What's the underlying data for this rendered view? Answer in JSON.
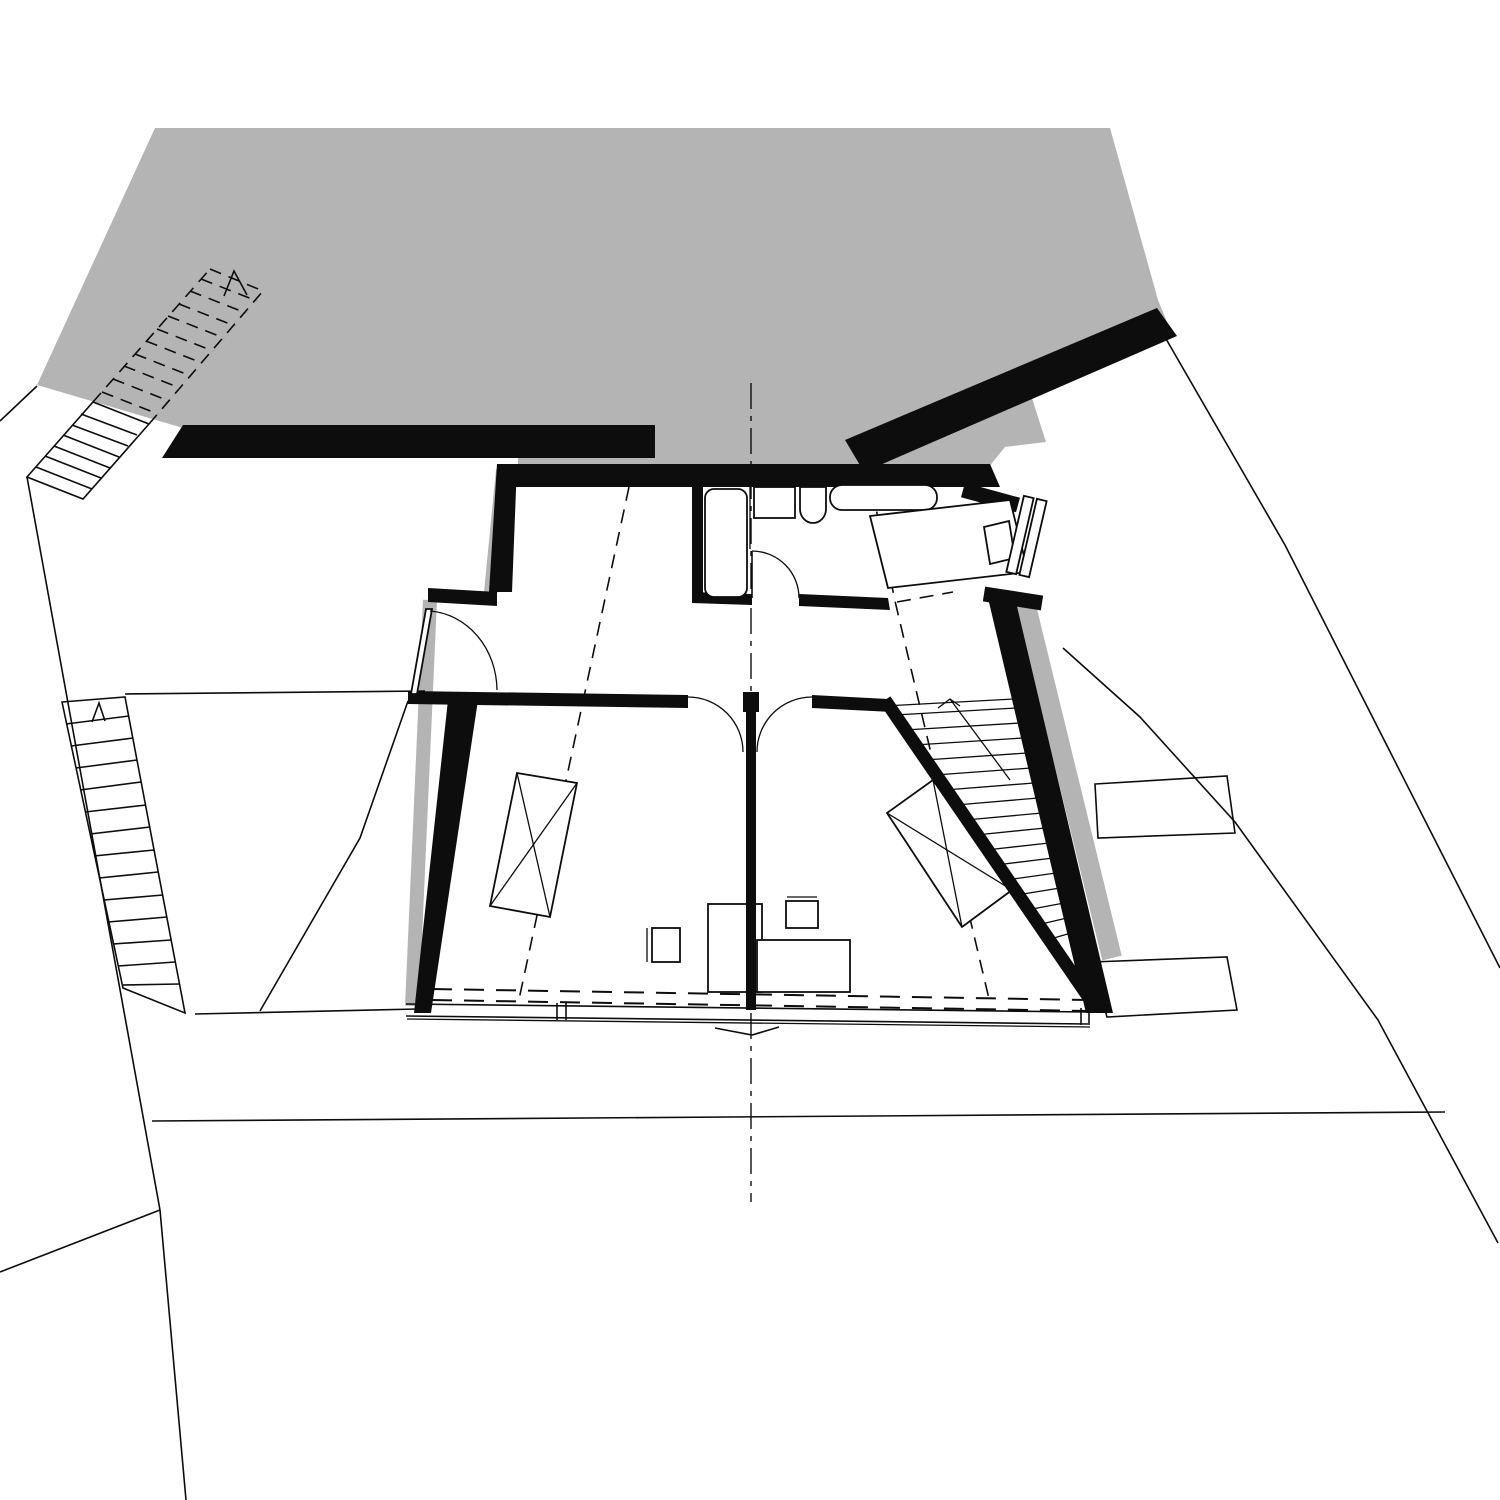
{
  "document": {
    "kind": "architectural-floor-plan",
    "view": "top-down plan, attic / upper floor",
    "visible_text": [],
    "colors": {
      "paper": "#ffffff",
      "ink": "#0d0d0d",
      "neighbor_mass_gray": "#b4b4b4",
      "wall_fill": "#000000"
    },
    "legend": {
      "gray_mass": "adjacent building / uphill neighbor volume",
      "thick_black": "load-bearing walls (cut)",
      "thin_lines": "site boundaries, terraces, furniture",
      "dashed_lines": "roof slope / headroom projection lines",
      "dash_dot_line": "central axis / section line",
      "hatched_strips": "staircases (exterior upper-left, exterior mid-left, interior right)",
      "fixtures": [
        "shower",
        "washbasin",
        "wc",
        "bathtub",
        "bed-in-wall-niche",
        "bed-left-room",
        "bed-right-room",
        "desk-left",
        "chair-left",
        "desk-right",
        "chair-right",
        "window-band-south",
        "terrace-steps-right"
      ]
    }
  }
}
